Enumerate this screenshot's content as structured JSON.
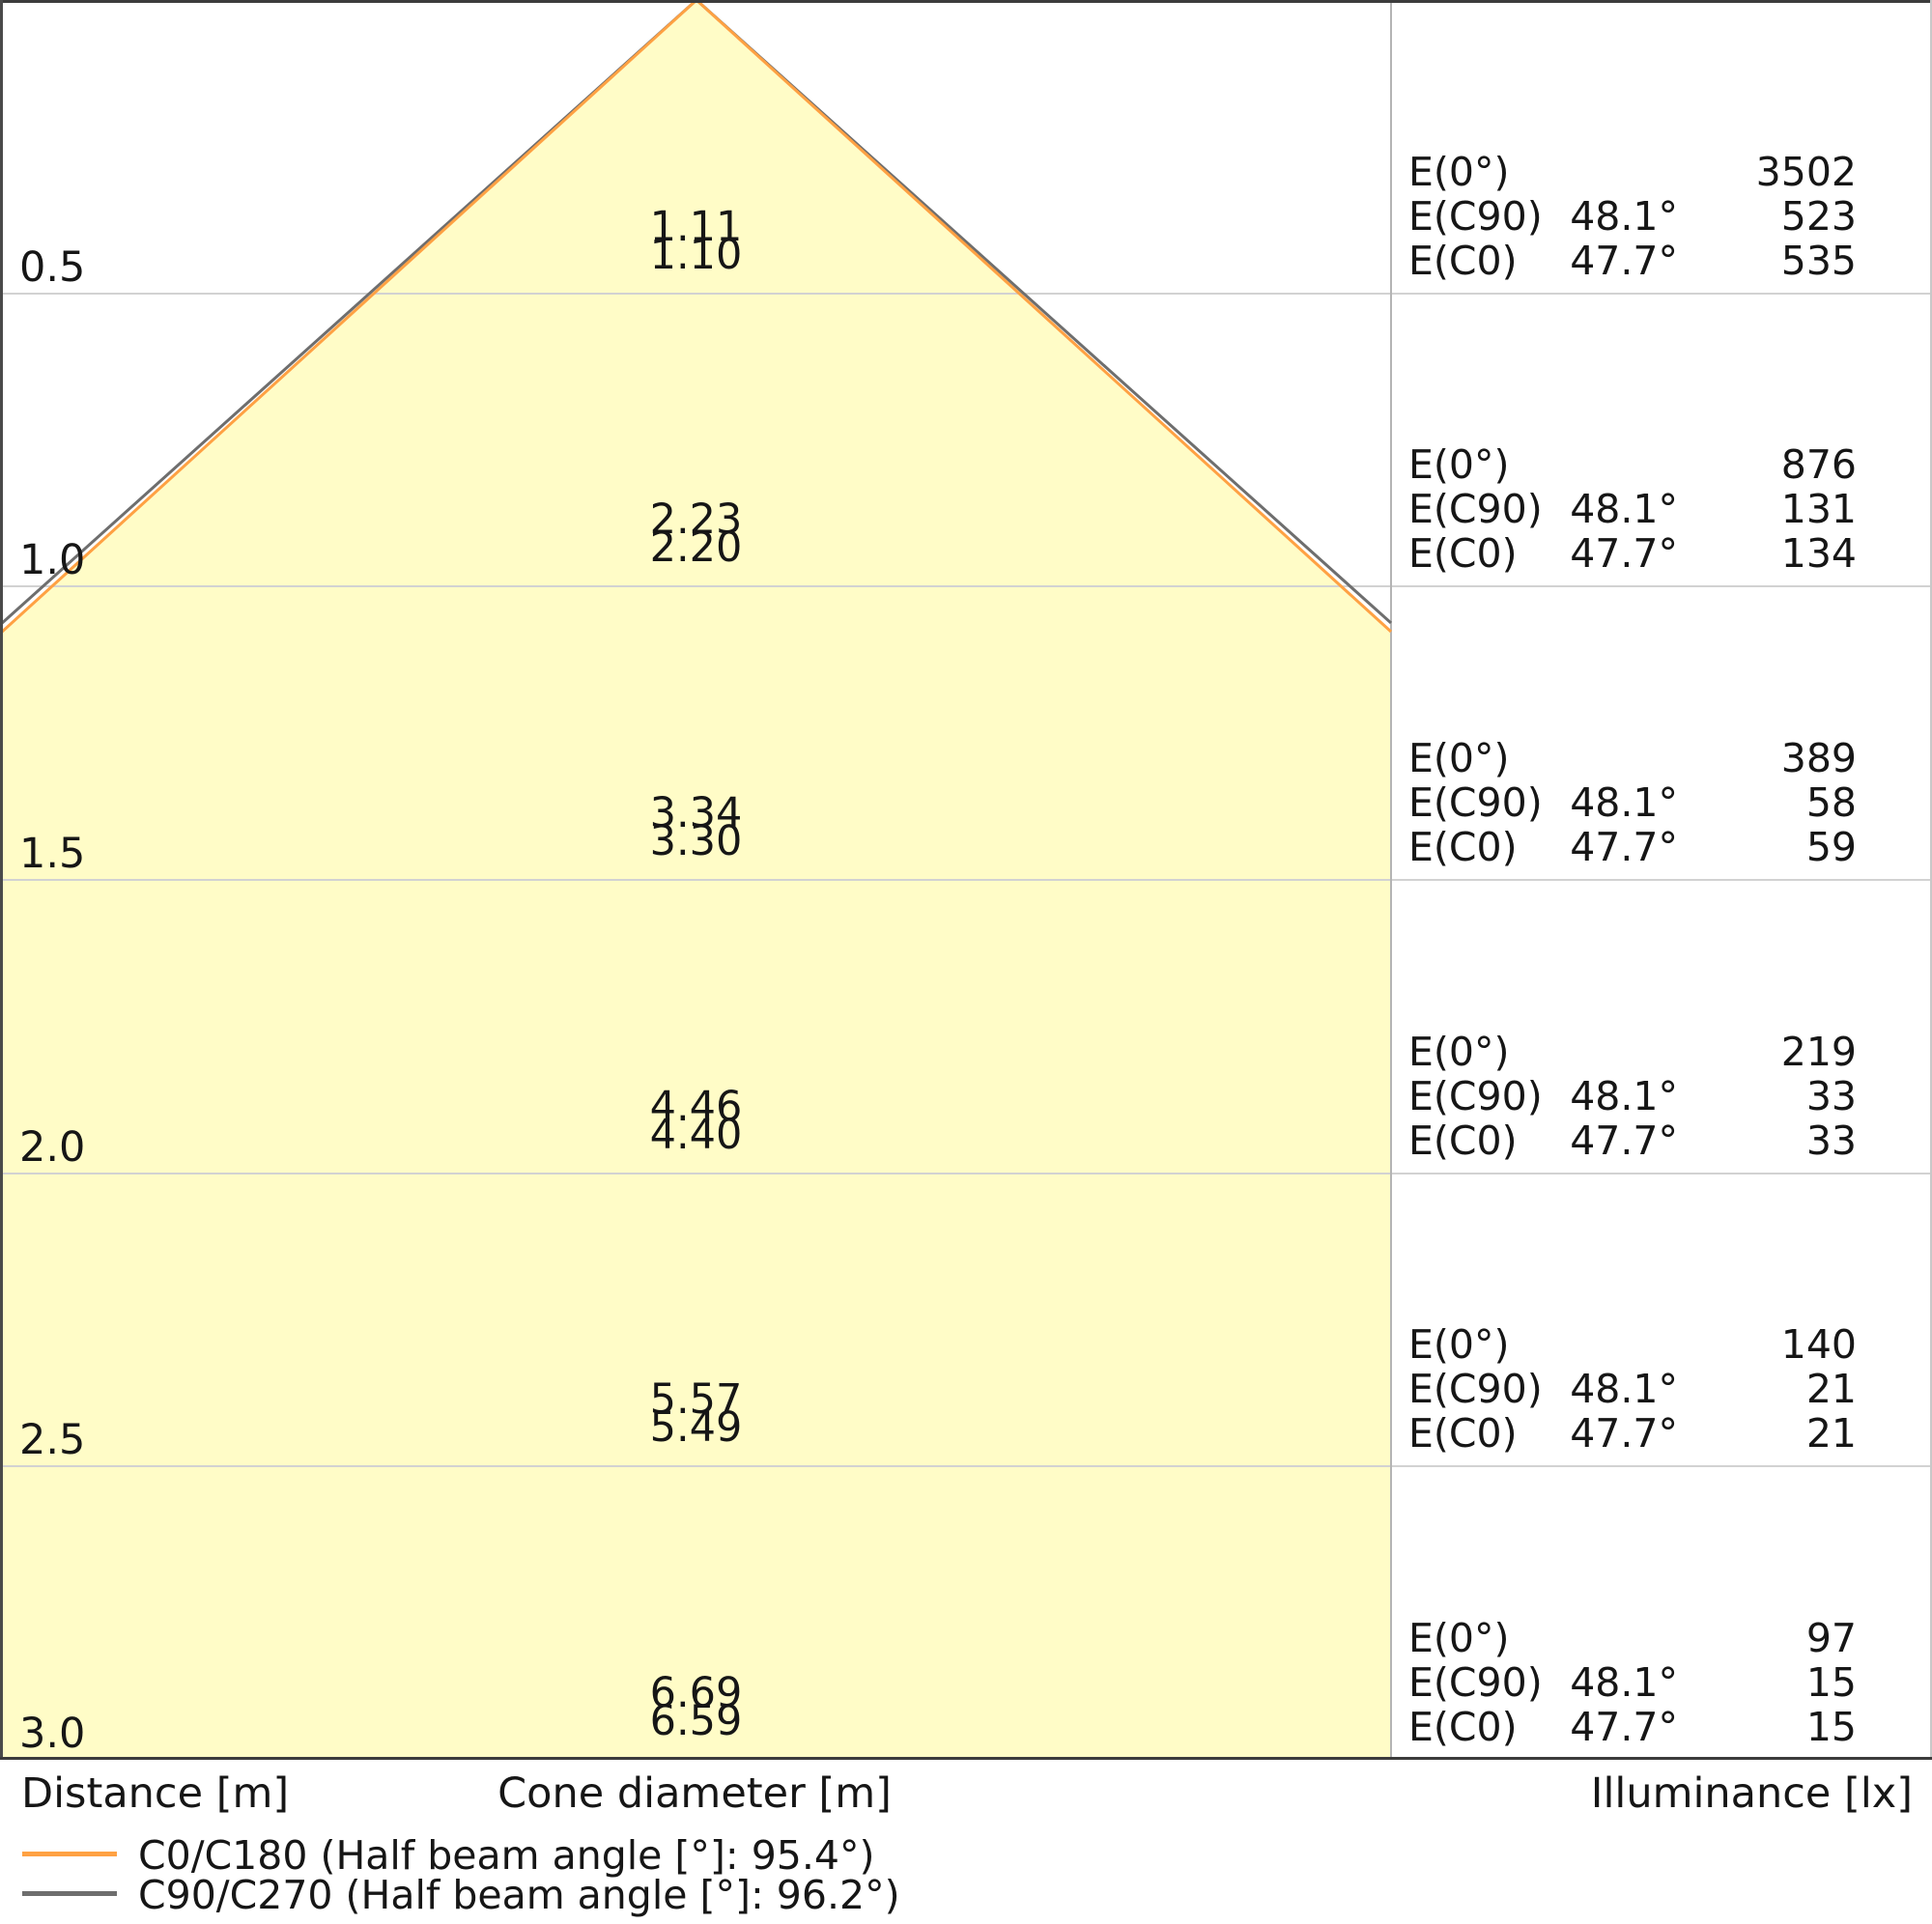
{
  "chart_data": {
    "type": "cone-diagram",
    "description": "Light cone diagram: beam cone vs mounting distance with cone diameter and illuminance table",
    "x_axis_label": "Distance [m]",
    "center_axis_label": "Cone diameter [m]",
    "right_axis_label": "Illuminance [lx]",
    "distances_m": [
      0.5,
      1.0,
      1.5,
      2.0,
      2.5,
      3.0
    ],
    "cone_fill_color": "#FFFCC7",
    "grid_color": "#D2D2D2",
    "series": [
      {
        "name": "C0/C180",
        "half_beam_angle_deg": 95.4,
        "color": "#FFA143",
        "cone_diameters_m": [
          1.1,
          2.2,
          3.3,
          4.4,
          5.49,
          6.59
        ]
      },
      {
        "name": "C90/C270",
        "half_beam_angle_deg": 96.2,
        "color": "#6E6E6E",
        "cone_diameters_m": [
          1.11,
          2.23,
          3.34,
          4.46,
          5.57,
          6.69
        ]
      }
    ],
    "rows": [
      {
        "distance": "0.5",
        "cone_d_c90": "1.11",
        "cone_d_c0": "1.10",
        "e0_lx": "3502",
        "ec90_angle": "48.1°",
        "ec90_lx": "523",
        "ec0_angle": "47.7°",
        "ec0_lx": "535"
      },
      {
        "distance": "1.0",
        "cone_d_c90": "2.23",
        "cone_d_c0": "2.20",
        "e0_lx": "876",
        "ec90_angle": "48.1°",
        "ec90_lx": "131",
        "ec0_angle": "47.7°",
        "ec0_lx": "134"
      },
      {
        "distance": "1.5",
        "cone_d_c90": "3.34",
        "cone_d_c0": "3.30",
        "e0_lx": "389",
        "ec90_angle": "48.1°",
        "ec90_lx": "58",
        "ec0_angle": "47.7°",
        "ec0_lx": "59"
      },
      {
        "distance": "2.0",
        "cone_d_c90": "4.46",
        "cone_d_c0": "4.40",
        "e0_lx": "219",
        "ec90_angle": "48.1°",
        "ec90_lx": "33",
        "ec0_angle": "47.7°",
        "ec0_lx": "33"
      },
      {
        "distance": "2.5",
        "cone_d_c90": "5.57",
        "cone_d_c0": "5.49",
        "e0_lx": "140",
        "ec90_angle": "48.1°",
        "ec90_lx": "21",
        "ec0_angle": "47.7°",
        "ec0_lx": "21"
      },
      {
        "distance": "3.0",
        "cone_d_c90": "6.69",
        "cone_d_c0": "6.59",
        "e0_lx": "97",
        "ec90_angle": "48.1°",
        "ec90_lx": "15",
        "ec0_angle": "47.7°",
        "ec0_lx": "15"
      }
    ]
  },
  "labels": {
    "e0": "E(0°)",
    "ec90": "E(C90)",
    "ec0": "E(C0)"
  },
  "axes": {
    "distance": "Distance [m]",
    "cone_diameter": "Cone diameter [m]",
    "illuminance": "Illuminance [lx]"
  },
  "legend": [
    {
      "label": "C0/C180 (Half beam angle [°]: 95.4°)",
      "color": "#FFA143"
    },
    {
      "label": "C90/C270 (Half beam angle [°]: 96.2°)",
      "color": "#6E6E6E"
    }
  ]
}
